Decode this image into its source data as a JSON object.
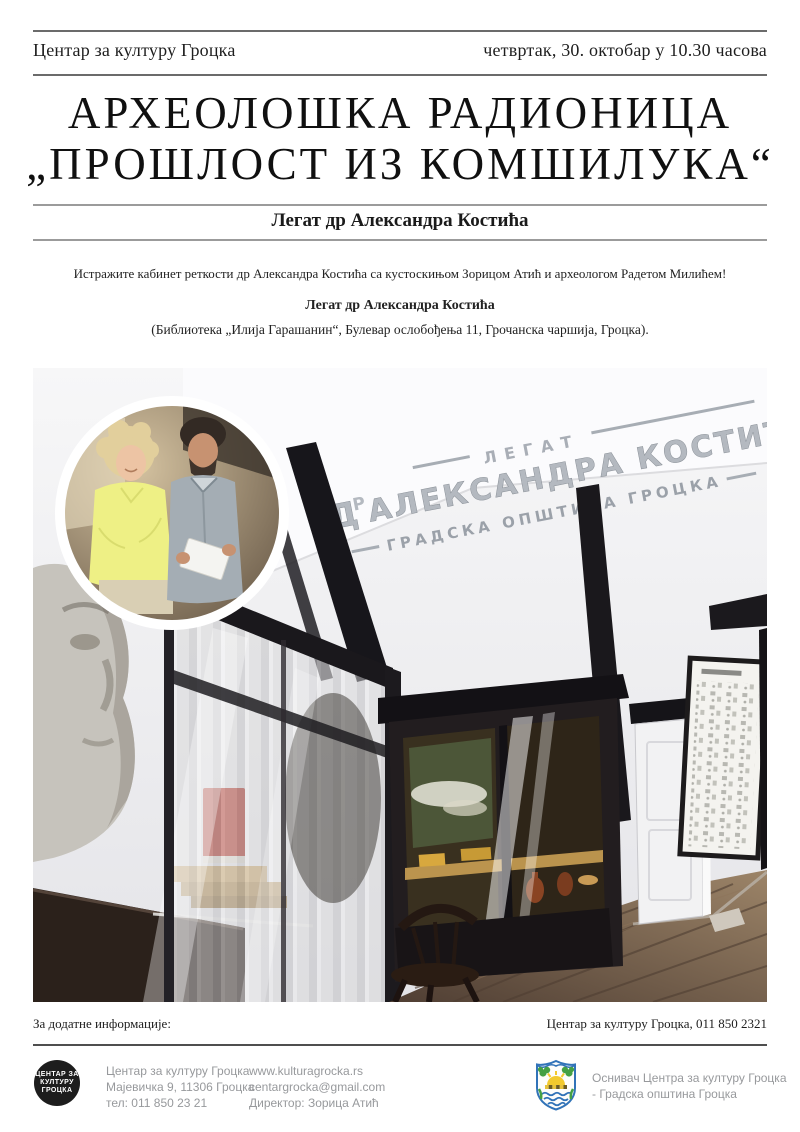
{
  "header": {
    "org": "Центар за културу Гроцка",
    "datetime": "четвртак, 30. октобар у 10.30 часова"
  },
  "title": {
    "line1": "АРХЕОЛОШКА РАДИОНИЦА",
    "line2": "„ПРОШЛОСТ ИЗ КОМШИЛУКА“"
  },
  "subtitle": "Легат др Александра Костића",
  "intro": {
    "invite": "Истражите кабинет реткости др Александра Костића са кустоскињом Зорицом Атић и археологом Радетом Милићем!",
    "legacy": "Легат др Александра Костића",
    "location": "(Библиотека „Илија Гарашанин“, Булевар ослобођења 11, Грочанска чаршија, Гроцка)."
  },
  "photo_sign": {
    "top": "ЛЕГАТ",
    "initial": "Д",
    "sup": "Р",
    "name": "АЛЕКСАНДРА КОСТИЋ",
    "bottom": "ГРАДСКА ОПШТИНА ГРОЦКА"
  },
  "info": {
    "label": "За додатне информације:",
    "contact": "Центар за културу Гроцка, 011 850 2321"
  },
  "footer": {
    "logo": [
      "ЦЕНТАР ЗА",
      "КУЛТУРУ",
      "ГРОЦКА"
    ],
    "address": [
      "Центар за културу Гроцка",
      "Мајевичка 9, 11306 Гроцка",
      "тел: 011 850 23 21"
    ],
    "contacts": [
      "www.kulturagrocka.rs",
      "centargrocka@gmail.com",
      "Директор: Зорица Атић"
    ],
    "founder": [
      "Оснивач Центра за културу Гроцка",
      "- Градска општина Гроцка"
    ]
  },
  "colors": {
    "rule_dark": "#4f4f4f",
    "rule_gray": "#6b6b6b",
    "footer_text": "#97999c",
    "logo_bg": "#1d1d1d",
    "arms_blue": "#3173b8",
    "arms_green": "#44a044",
    "arms_yellow": "#f2ca2e",
    "accent_book_red": "#b5372b"
  }
}
